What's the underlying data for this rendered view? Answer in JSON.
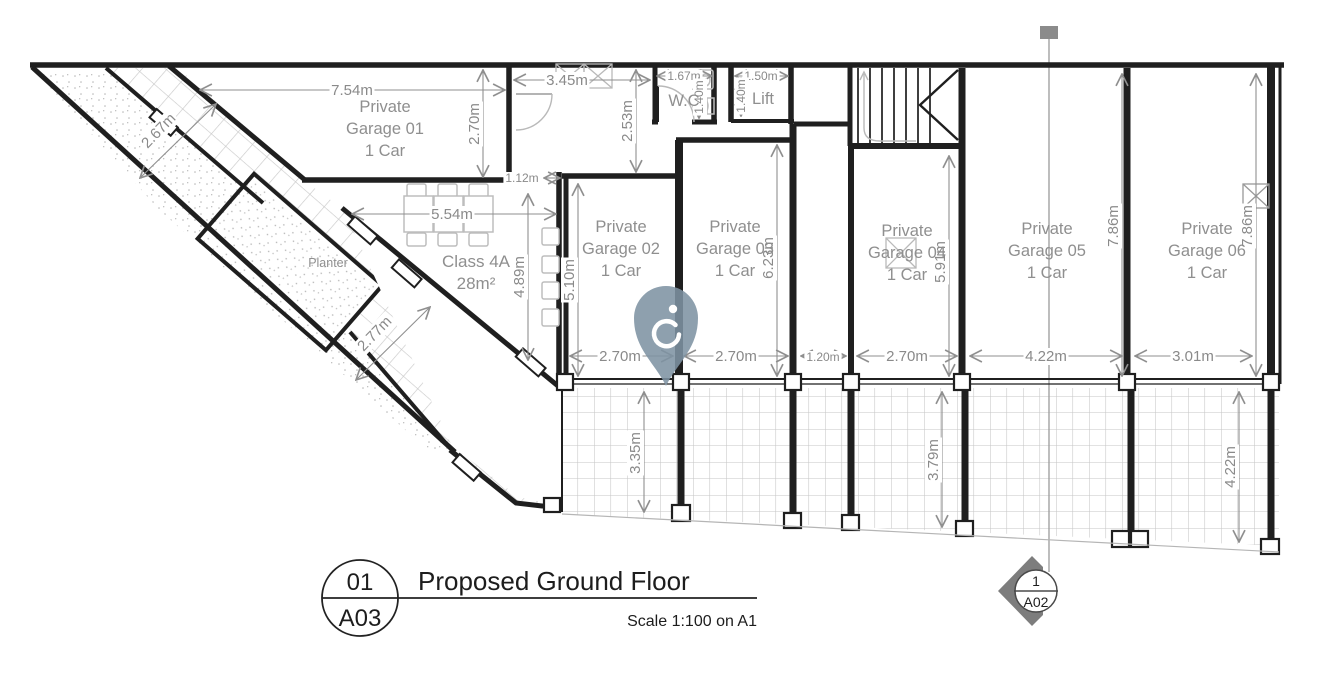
{
  "drawing": {
    "rooms": {
      "garage01": {
        "line1": "Private",
        "line2": "Garage 01",
        "line3": "1 Car"
      },
      "garage02": {
        "line1": "Private",
        "line2": "Garage 02",
        "line3": "1 Car"
      },
      "garage03": {
        "line1": "Private",
        "line2": "Garage 03",
        "line3": "1 Car"
      },
      "garage04": {
        "line1": "Private",
        "line2": "Garage 04",
        "line3": "1 Car"
      },
      "garage05": {
        "line1": "Private",
        "line2": "Garage 05",
        "line3": "1 Car"
      },
      "garage06": {
        "line1": "Private",
        "line2": "Garage 06",
        "line3": "1 Car"
      },
      "class4a": {
        "line1": "Class 4A",
        "line2": "28m²"
      },
      "wc": {
        "label": "W.C"
      },
      "lift": {
        "label": "Lift"
      },
      "planter": {
        "label": "Planter"
      }
    },
    "dimensions": {
      "g1_w": "7.54m",
      "g1_d": "2.70m",
      "lobby_w": "3.45m",
      "lobby_d": "2.53m",
      "wc_w": "1.67m",
      "wc_d": "1.40m",
      "lift_w": "1.50m",
      "lift_d": "1.40m",
      "off": "1.12m",
      "class_w": "5.54m",
      "class_d": "4.89m",
      "walk_a": "2.67m",
      "walk_b": "2.77m",
      "g2_d": "5.10m",
      "g2_w": "2.70m",
      "g3_d": "6.23m",
      "g3_w": "2.70m",
      "corr_w": "1.20m",
      "g4_d": "5.91m",
      "g4_w": "2.70m",
      "g5_w": "4.22m",
      "g5_d": "7.86m",
      "g6_w": "3.01m",
      "g6_d": "7.86m",
      "pav_l": "3.35m",
      "pav_m": "3.79m",
      "pav_r": "4.22m"
    },
    "title_block": {
      "detail_number": "01",
      "sheet_number": "A03",
      "title": "Proposed Ground Floor",
      "scale_note": "Scale 1:100 on A1"
    },
    "section_marker": {
      "detail_number": "1",
      "sheet_number": "A02"
    },
    "colors": {
      "pin_marker": "#7e93a3",
      "wall": "#1f1f1f",
      "dimension_grey": "#8a8a8a",
      "hatch_grey": "#c6c6c6",
      "section_marker_grey": "#7d7d7d"
    }
  }
}
